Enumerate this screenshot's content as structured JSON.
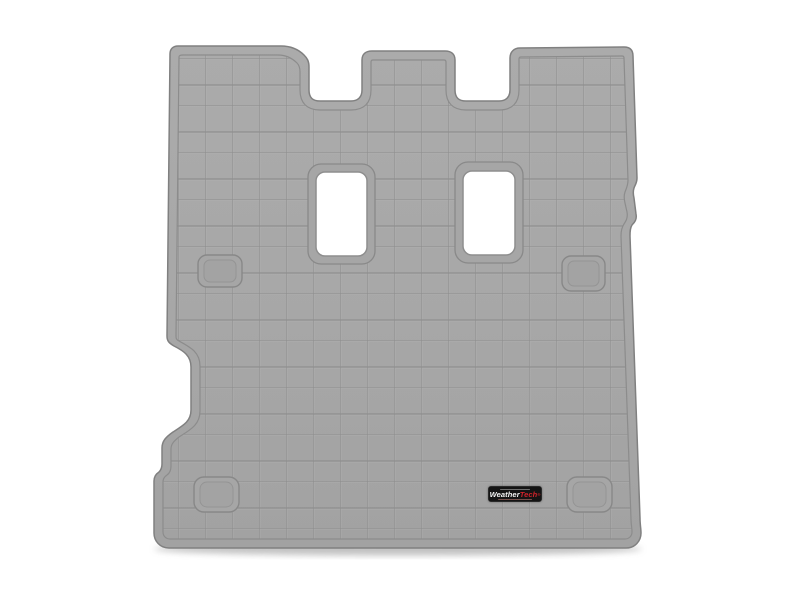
{
  "scene": {
    "type": "product-photo",
    "description": "Top-down product photo of a grey WeatherTech vehicle cargo/trunk liner floor mat on a white background: square tread grid, three tabs with two notches along the top edge, two white rectangular anchor cutouts in the upper half, a notched left edge, four recessed rounded pads, and a small black WeatherTech badge near the bottom",
    "background_color": "#ffffff"
  },
  "mat": {
    "color_name": "Grey",
    "base_color": "#a7a7a7",
    "grid_line_color": "#8a8a8a",
    "grid_highlight_color": "#b9b9b9",
    "edge_line_color": "#808080",
    "rim_line_color": "#8c8c8c",
    "cutout_fill": "#ffffff",
    "cutout_count": 2,
    "recess_pad_count": 4,
    "shadow_color": "#8f8f8f"
  },
  "badge": {
    "microtext_top": "",
    "brand_white": "Weather",
    "brand_red": "Tech",
    "registered_mark": "®",
    "microtext_bottom": "",
    "background_color": "#141414",
    "accent_red": "#d2232a",
    "text_white": "#f5f5f5"
  }
}
